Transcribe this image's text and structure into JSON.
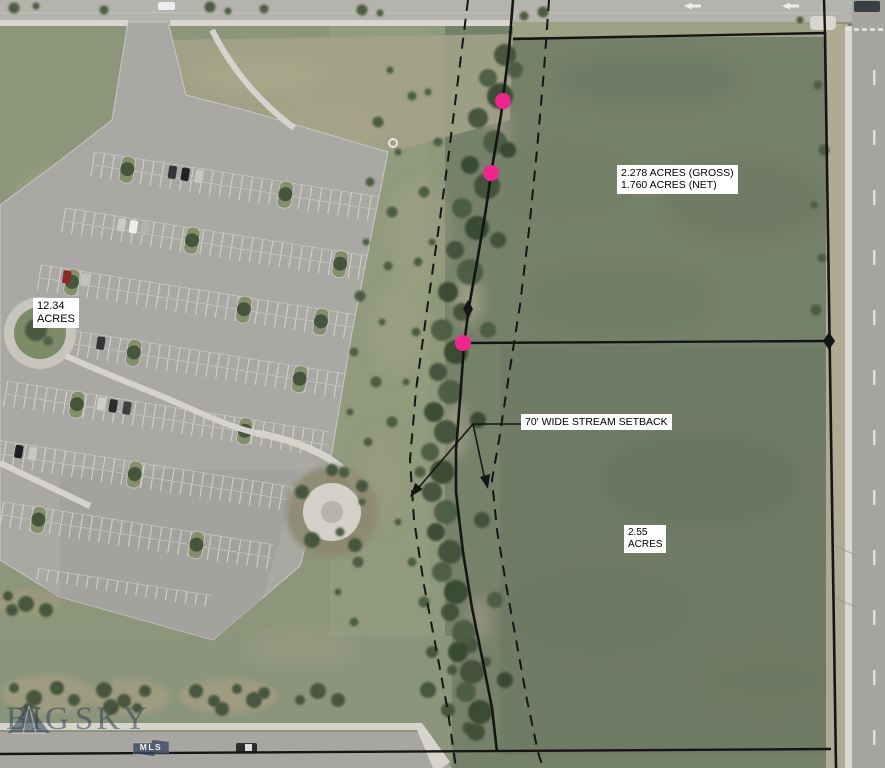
{
  "annotations": {
    "parcel_acreage_left": {
      "line1": "12.34",
      "line2": "ACRES"
    },
    "parcel_acreage_gross_net": {
      "line1": "2.278 ACRES (GROSS)",
      "line2": "1.760 ACRES (NET)"
    },
    "stream_setback_label": "70' WIDE STREAM SETBACK",
    "parcel_acreage_bottom": {
      "line1": "2.55",
      "line2": "ACRES"
    }
  },
  "watermark": {
    "brand_word_1": "BIG",
    "brand_word_2": "SKY",
    "badge": "MLS"
  },
  "colors": {
    "survey_line": "#151515",
    "survey_point_pink": "#f0268f",
    "label_background": "#ffffff",
    "label_text": "#000000"
  }
}
